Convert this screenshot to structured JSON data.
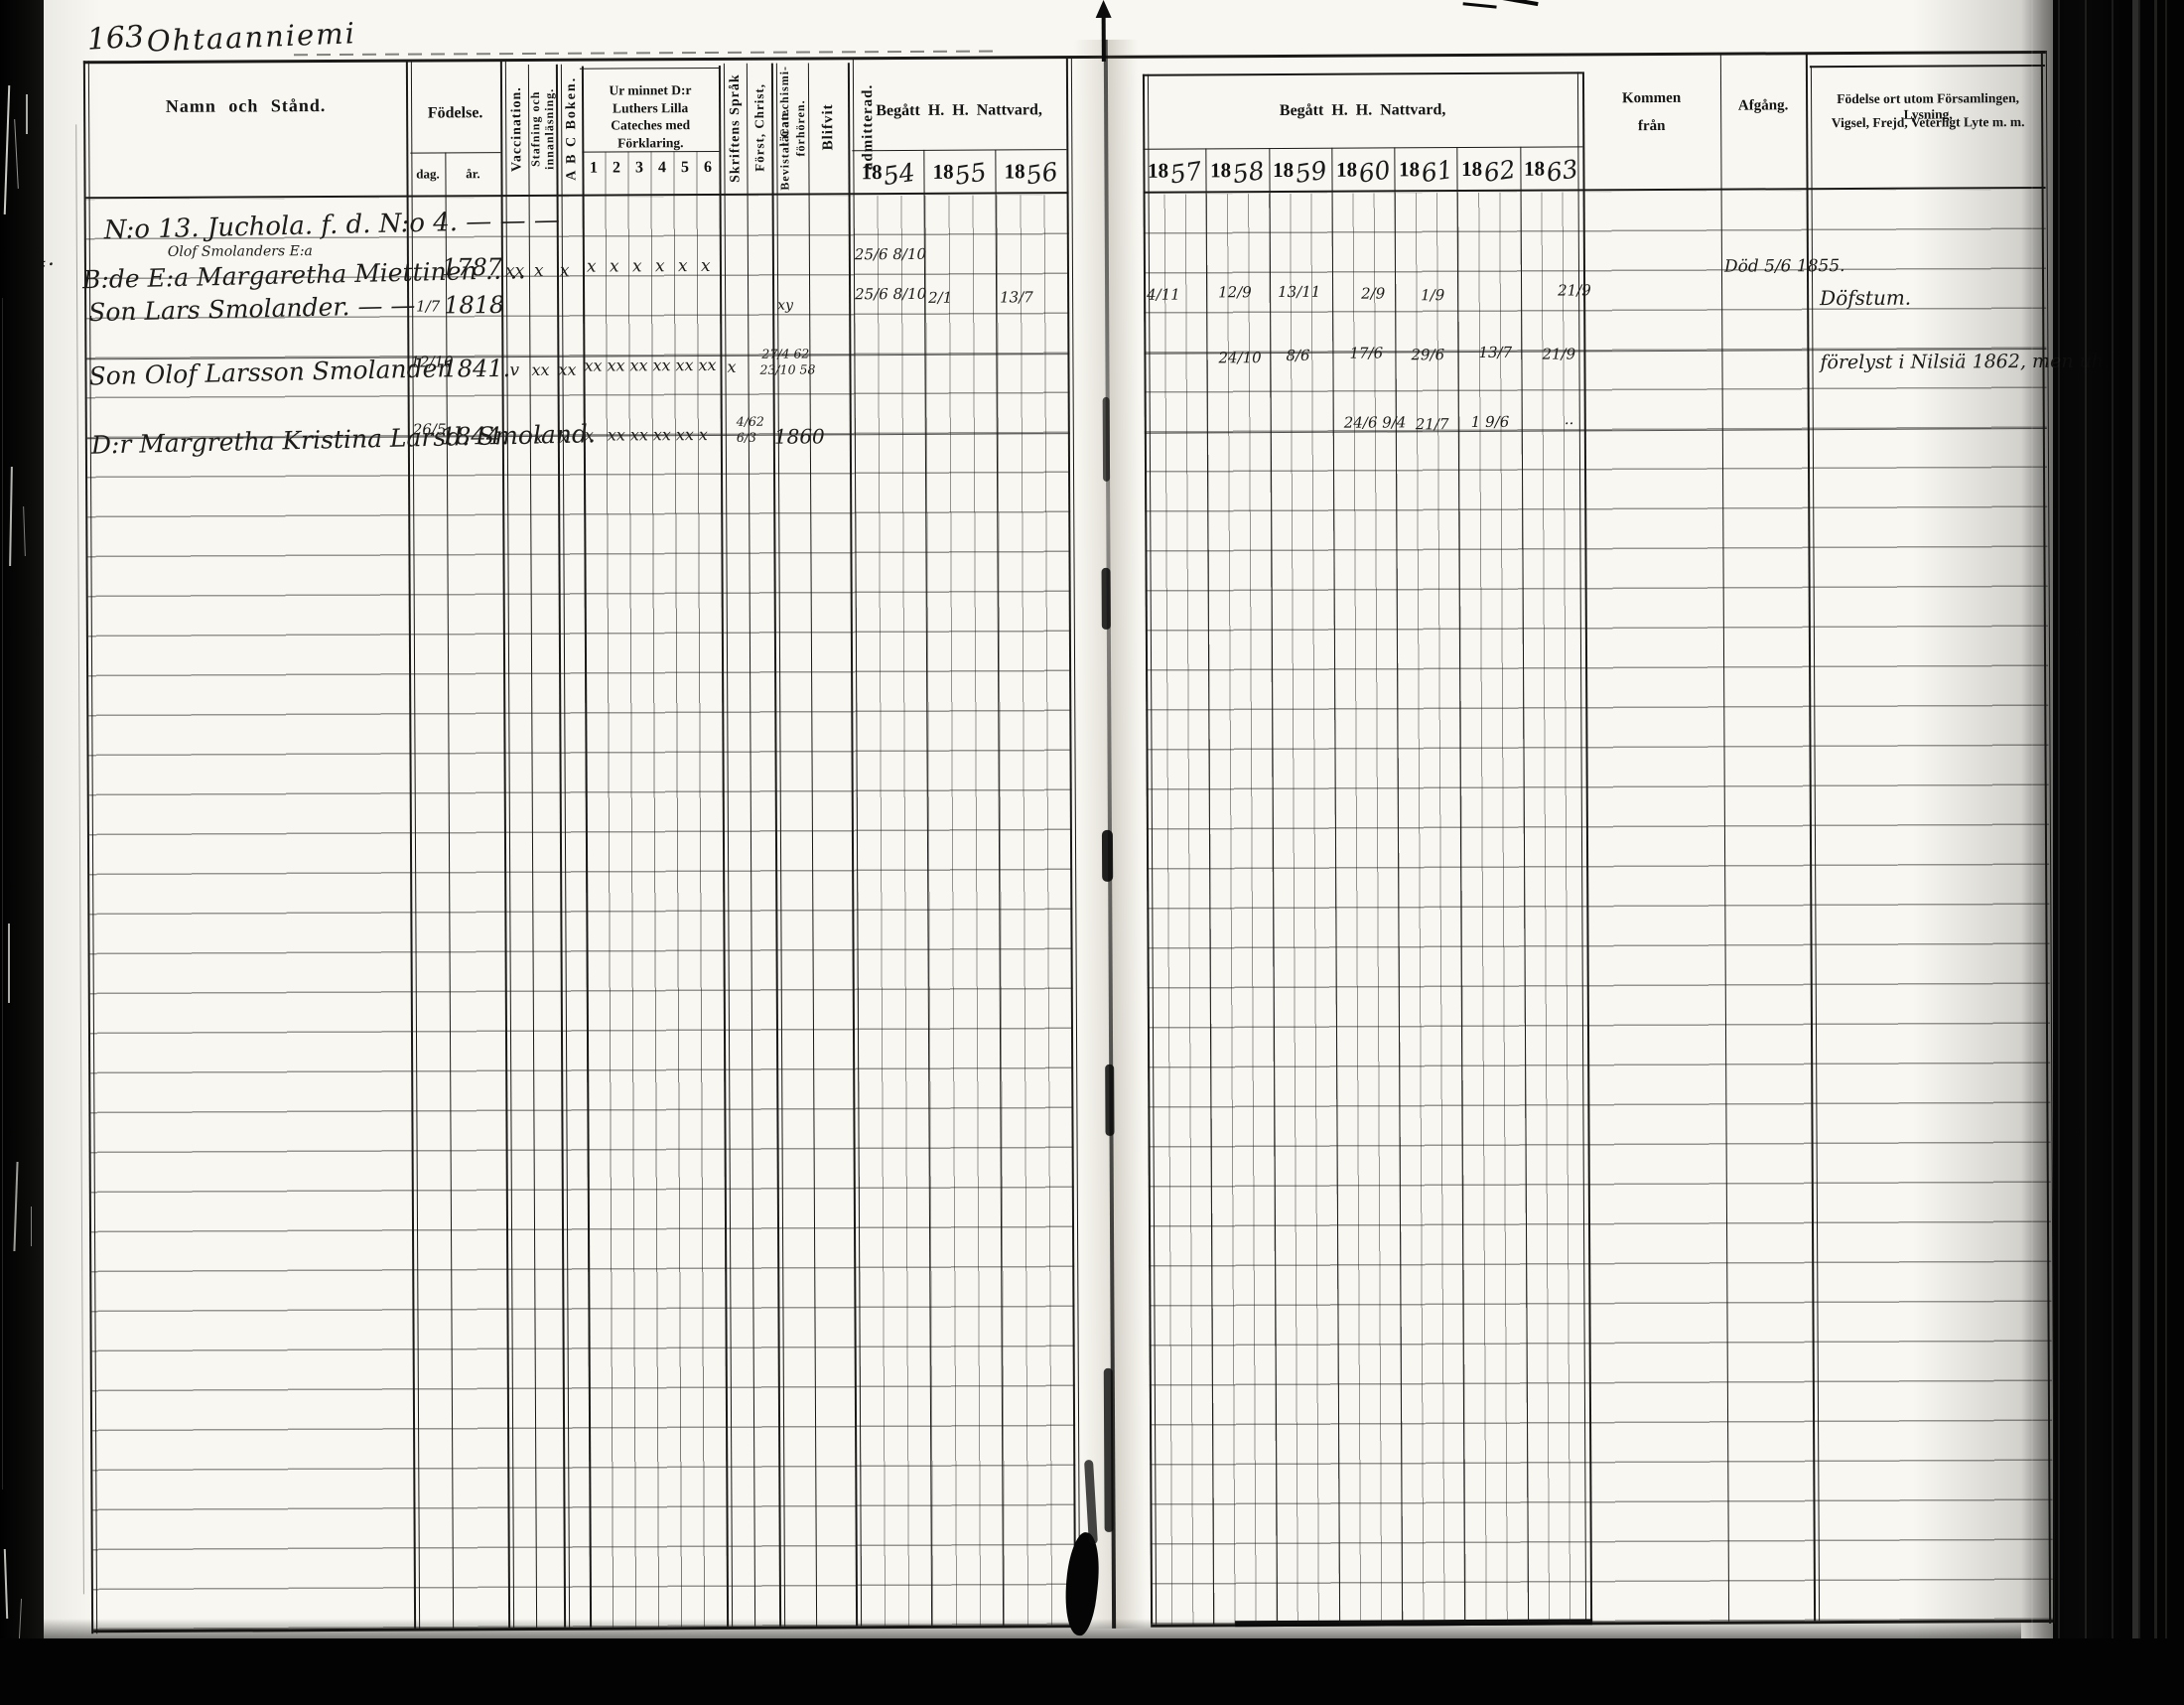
{
  "page": {
    "number": "163",
    "title": "Ohtaanniemi"
  },
  "header": {
    "namn": "Namn och Stånd.",
    "fodelse": "Födelse.",
    "dag": "dag.",
    "ar": "år.",
    "vaccination": "Vaccination.",
    "stafning_1": "Stafning och",
    "stafning_2": "innanläsning.",
    "abc": "A B C Boken.",
    "cateches": "Ur minnet D:r Luthers Lilla Cateches med Förklaring.",
    "cateches_nums": [
      "1",
      "2",
      "3",
      "4",
      "5",
      "6"
    ],
    "skriftens": "Skriftens Språk",
    "forst": "Först, Christ, läran.",
    "bevistat_1": "Bevistat Catechismi-",
    "bevistat_2": "förhören.",
    "blifvit": "Blifvit admitterad.",
    "nattvard_left": "Begått H. H. Nattvard,",
    "nattvard_right": "Begått H. H. Nattvard,",
    "years_left": [
      {
        "p": "18",
        "s": "54"
      },
      {
        "p": "18",
        "s": "55"
      },
      {
        "p": "18",
        "s": "56"
      }
    ],
    "years_right": [
      {
        "p": "18",
        "s": "57"
      },
      {
        "p": "18",
        "s": "58"
      },
      {
        "p": "18",
        "s": "59"
      },
      {
        "p": "18",
        "s": "60"
      },
      {
        "p": "18",
        "s": "61"
      },
      {
        "p": "18",
        "s": "62"
      },
      {
        "p": "18",
        "s": "63"
      }
    ],
    "kommen_1": "Kommen",
    "kommen_2": "från",
    "afgang": "Afgång.",
    "notes_1": "Födelse ort utom Församlingen, Lysning,",
    "notes_2": "Vigsel, Frejd, Veterligt Lyte m. m."
  },
  "margin_mark": "4.",
  "rows": [
    {
      "name": "N:o 13. Juchola. f. d. N:o 4. — — —"
    },
    {
      "note_above": "Olof Smolanders E:a",
      "name": "B:de E:a Margaretha Miettinen ‥ ‥",
      "birth_year": "1787",
      "vacc": "xx",
      "staf": "x",
      "abc": "x",
      "cat": [
        "x",
        "x",
        "x",
        "x",
        "x",
        "x"
      ],
      "n1854": "25/6  8/10",
      "afgang": "Död 5/6 1855."
    },
    {
      "name": "Son Lars Smolander. — —",
      "birth_day": "1/7",
      "birth_year": "1818",
      "bevistat": "xy",
      "n1854": "25/6  8/10",
      "n1855": "2/1",
      "n1856": "13/7",
      "n1857": "4/11",
      "n1858": "12/9",
      "n1859": "13/11",
      "n1860": "2/9",
      "n1861": "1/9",
      "n1863": "21/9",
      "notes": "Döfstum."
    },
    {
      "name": "Son Olof Larsson Smolander",
      "birth_day": "12/10",
      "birth_year": "1841.",
      "vacc": "v",
      "staf": "xx",
      "abc": "xx",
      "cat": [
        "xx",
        "xx",
        "xx",
        "xx",
        "xx",
        "xx"
      ],
      "skrift": "x",
      "bev1": "27/4 62",
      "bev2": "23/10 58",
      "n1858": "24/10",
      "n1859": "8/6",
      "n1860": "17/6",
      "n1861": "29/6",
      "n1862": "13/7",
      "n1863": "21/9",
      "notes": "förelyst i Nilsiä 1862, men uh. Gifjoby"
    },
    {
      "name": "D:r Margretha Kristina Larsd. Smoland.",
      "birth_day": "26/5",
      "birth_year": "1844.",
      "staf": "x",
      "abc": "x",
      "cat": [
        "x",
        "xx",
        "xx",
        "xx",
        "xx",
        "x"
      ],
      "bev1": "4/62",
      "bev2": "6/3",
      "blifvit": "1860",
      "n1860": "24/6  9/4",
      "n1861": "21/7",
      "n1862": "1  9/6",
      "n1863": "··"
    }
  ]
}
